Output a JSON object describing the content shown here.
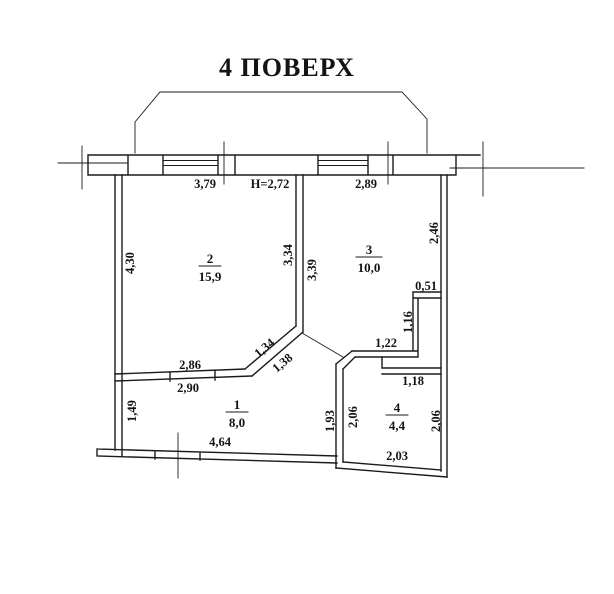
{
  "title": "4 ПОВЕРХ",
  "plan": {
    "ceiling_height": "H=2,72",
    "rooms": [
      {
        "number": "1",
        "area": "8,0"
      },
      {
        "number": "2",
        "area": "15,9"
      },
      {
        "number": "3",
        "area": "10,0"
      },
      {
        "number": "4",
        "area": "4,4"
      }
    ],
    "dims": {
      "top_left": "3,79",
      "top_right": "2,89",
      "room2_left": "4,30",
      "mid_wall_left": "3,34",
      "mid_wall_right": "3,39",
      "room3_right": "2,46",
      "step": "0,51",
      "niche_vertical": "1,16",
      "niche_horizontal": "1,22",
      "room4_top": "1,18",
      "diag_upper": "1,34",
      "diag_lower": "1,38",
      "room2_bottom_above": "2,86",
      "room2_bottom_below": "2,90",
      "room1_left": "1,49",
      "room1_bottom": "4,64",
      "room4_left_outer": "1,93",
      "room4_left_inner": "2,06",
      "room4_right": "2,06",
      "room4_bottom": "2,03"
    }
  },
  "colors": {
    "ink": "#1b1b1b",
    "background": "#ffffff"
  }
}
